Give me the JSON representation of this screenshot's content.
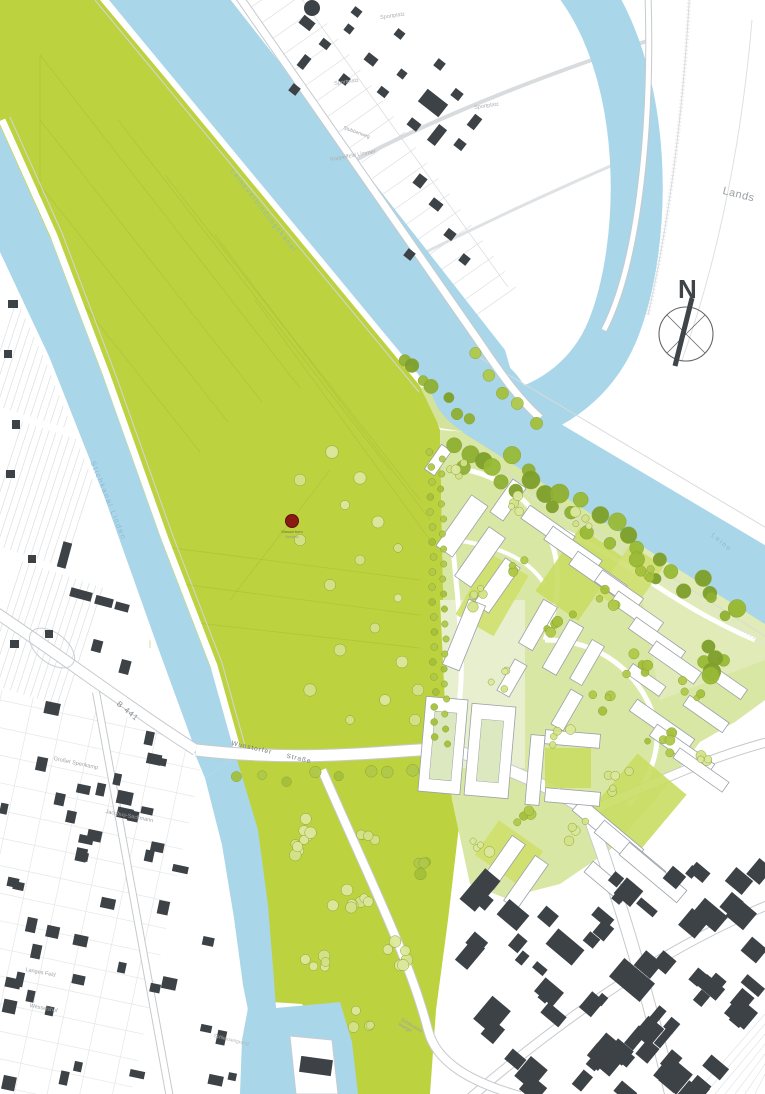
{
  "map": {
    "region_labels": {
      "canal_nw": "Leineverbindungskanal",
      "canal_w": "Stichkanal Linden",
      "river_e": "Leine",
      "area_ne_truncated": "Lands",
      "sports_field": "Sportplatz",
      "allotment_area": "Koppelfeld Limmer"
    },
    "street_labels": {
      "street_ne": "Stubbenweg",
      "road_b441": "B 441",
      "main_street": "Wunstorfer Straße",
      "street_spenkamp": "Großer Spenkamp",
      "street_jacobus": "Jacobus-Sackmann",
      "street_langes_feld": "Langes Feld",
      "street_wesselshof": "Wesselshof",
      "street_schleusengrund": "Schleusengrund",
      "lock_label_line1": "Schleusen-",
      "lock_label_line2": "wange"
    },
    "marker": {
      "label_line1": "Wasserturm",
      "label_line2": "Bestand",
      "color": "#8a1a12"
    },
    "compass": {
      "north": "N"
    },
    "colors": {
      "site_green": "#bdd23f",
      "development_green": "#d9e7a4",
      "water_blue": "#a9d6e8",
      "existing_building": "#3d4246",
      "new_building_outline": "#9aa0a6",
      "marker_red": "#8a1a12"
    }
  }
}
